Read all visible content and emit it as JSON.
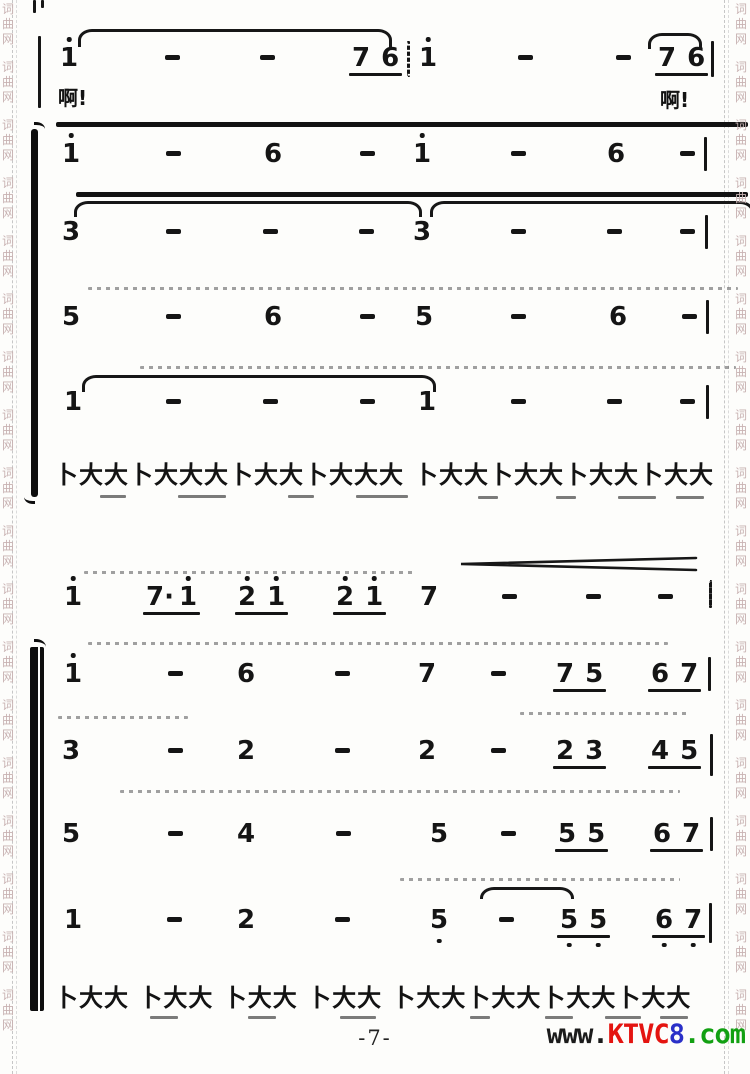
{
  "watermark": {
    "chars": [
      "词",
      "曲",
      "网"
    ],
    "color": "#c8b2b2"
  },
  "lyrics": {
    "ah_left": "啊!",
    "ah_right": "啊!",
    "row1_part1": "卜大大卜大大大卜大大卜大大大",
    "row1_part2": "卜大大卜大大卜大大卜大大",
    "row2": "卜大大 卜大大 卜大大 卜大大 卜大大卜大大卜大大卜大大"
  },
  "footer": {
    "page_number": "-7-",
    "site": [
      {
        "text": "www.",
        "color": "#1b1b1b"
      },
      {
        "text": "KTVC",
        "color": "#e41410"
      },
      {
        "text": "8",
        "color": "#2a30c8"
      },
      {
        "text": ".com",
        "color": "#12a012"
      }
    ]
  },
  "notation": {
    "rows": [
      {
        "id": "tail-voice",
        "y": 44,
        "tokens": [
          {
            "k": "n",
            "x": 60,
            "d": "1",
            "hi": 1
          },
          {
            "k": "d",
            "x": 165
          },
          {
            "k": "d",
            "x": 260
          },
          {
            "k": "p",
            "x": 352,
            "ul": 1,
            "ds": [
              {
                "d": "7"
              },
              {
                "d": "6"
              }
            ]
          },
          {
            "k": "b",
            "x": 407,
            "dot": 1,
            "h": 36
          },
          {
            "k": "n",
            "x": 419,
            "d": "1",
            "hi": 1
          },
          {
            "k": "d",
            "x": 518
          },
          {
            "k": "d",
            "x": 616
          },
          {
            "k": "p",
            "x": 658,
            "ul": 1,
            "ds": [
              {
                "d": "7"
              },
              {
                "d": "6"
              }
            ]
          },
          {
            "k": "b",
            "x": 711,
            "h": 36
          }
        ]
      },
      {
        "id": "s1-v1",
        "y": 140,
        "tokens": [
          {
            "k": "n",
            "x": 62,
            "d": "1",
            "hi": 1
          },
          {
            "k": "d",
            "x": 166
          },
          {
            "k": "n",
            "x": 264,
            "d": "6"
          },
          {
            "k": "d",
            "x": 360
          },
          {
            "k": "n",
            "x": 413,
            "d": "1",
            "hi": 1
          },
          {
            "k": "d",
            "x": 511
          },
          {
            "k": "n",
            "x": 607,
            "d": "6"
          },
          {
            "k": "d",
            "x": 680
          },
          {
            "k": "b",
            "x": 704,
            "h": 34
          }
        ]
      },
      {
        "id": "s1-v2",
        "y": 218,
        "tokens": [
          {
            "k": "n",
            "x": 62,
            "d": "3"
          },
          {
            "k": "d",
            "x": 166
          },
          {
            "k": "d",
            "x": 263
          },
          {
            "k": "d",
            "x": 359
          },
          {
            "k": "n",
            "x": 413,
            "d": "3"
          },
          {
            "k": "d",
            "x": 511
          },
          {
            "k": "d",
            "x": 607
          },
          {
            "k": "d",
            "x": 680
          },
          {
            "k": "b",
            "x": 705,
            "h": 34
          }
        ]
      },
      {
        "id": "s1-v3",
        "y": 303,
        "tokens": [
          {
            "k": "n",
            "x": 62,
            "d": "5"
          },
          {
            "k": "d",
            "x": 166
          },
          {
            "k": "n",
            "x": 264,
            "d": "6"
          },
          {
            "k": "d",
            "x": 360
          },
          {
            "k": "n",
            "x": 415,
            "d": "5"
          },
          {
            "k": "d",
            "x": 511
          },
          {
            "k": "n",
            "x": 609,
            "d": "6"
          },
          {
            "k": "d",
            "x": 682
          },
          {
            "k": "b",
            "x": 706,
            "h": 34
          }
        ]
      },
      {
        "id": "s1-v4",
        "y": 388,
        "tokens": [
          {
            "k": "n",
            "x": 64,
            "d": "1"
          },
          {
            "k": "d",
            "x": 166
          },
          {
            "k": "d",
            "x": 263
          },
          {
            "k": "d",
            "x": 360
          },
          {
            "k": "n",
            "x": 418,
            "d": "1"
          },
          {
            "k": "d",
            "x": 511
          },
          {
            "k": "d",
            "x": 607
          },
          {
            "k": "d",
            "x": 680
          },
          {
            "k": "b",
            "x": 706,
            "h": 34
          }
        ]
      },
      {
        "id": "mid-voice",
        "y": 583,
        "tokens": [
          {
            "k": "n",
            "x": 64,
            "d": "1",
            "hi": 1
          },
          {
            "k": "p",
            "x": 146,
            "ul": 1,
            "g": 5,
            "ds": [
              {
                "d": "7·"
              },
              {
                "d": "1",
                "hi": 1
              }
            ]
          },
          {
            "k": "p",
            "x": 238,
            "ul": 1,
            "ds": [
              {
                "d": "2",
                "hi": 1
              },
              {
                "d": "1",
                "hi": 1
              }
            ]
          },
          {
            "k": "p",
            "x": 336,
            "ul": 1,
            "ds": [
              {
                "d": "2",
                "hi": 1
              },
              {
                "d": "1",
                "hi": 1
              }
            ]
          },
          {
            "k": "n",
            "x": 420,
            "d": "7"
          },
          {
            "k": "d",
            "x": 502
          },
          {
            "k": "d",
            "x": 586
          },
          {
            "k": "d",
            "x": 658
          },
          {
            "k": "b",
            "x": 709,
            "dot": 1,
            "h": 28
          }
        ]
      },
      {
        "id": "s2-v1",
        "y": 660,
        "tokens": [
          {
            "k": "n",
            "x": 64,
            "d": "1",
            "hi": 1
          },
          {
            "k": "d",
            "x": 168
          },
          {
            "k": "n",
            "x": 237,
            "d": "6"
          },
          {
            "k": "d",
            "x": 335
          },
          {
            "k": "n",
            "x": 418,
            "d": "7"
          },
          {
            "k": "d",
            "x": 491
          },
          {
            "k": "p",
            "x": 556,
            "ul": 1,
            "ds": [
              {
                "d": "7"
              },
              {
                "d": "5"
              }
            ]
          },
          {
            "k": "p",
            "x": 651,
            "ul": 1,
            "ds": [
              {
                "d": "6"
              },
              {
                "d": "7"
              }
            ]
          },
          {
            "k": "b",
            "x": 708,
            "h": 34
          }
        ]
      },
      {
        "id": "s2-v2",
        "y": 737,
        "tokens": [
          {
            "k": "n",
            "x": 62,
            "d": "3"
          },
          {
            "k": "d",
            "x": 168
          },
          {
            "k": "n",
            "x": 237,
            "d": "2"
          },
          {
            "k": "d",
            "x": 335
          },
          {
            "k": "n",
            "x": 418,
            "d": "2"
          },
          {
            "k": "d",
            "x": 491
          },
          {
            "k": "p",
            "x": 556,
            "ul": 1,
            "ds": [
              {
                "d": "2"
              },
              {
                "d": "3"
              }
            ]
          },
          {
            "k": "p",
            "x": 651,
            "ul": 1,
            "ds": [
              {
                "d": "4"
              },
              {
                "d": "5"
              }
            ]
          },
          {
            "k": "b",
            "x": 710,
            "h": 42
          }
        ]
      },
      {
        "id": "s2-v3",
        "y": 820,
        "tokens": [
          {
            "k": "n",
            "x": 62,
            "d": "5"
          },
          {
            "k": "d",
            "x": 168
          },
          {
            "k": "n",
            "x": 237,
            "d": "4"
          },
          {
            "k": "d",
            "x": 336
          },
          {
            "k": "n",
            "x": 430,
            "d": "5"
          },
          {
            "k": "d",
            "x": 501
          },
          {
            "k": "p",
            "x": 558,
            "ul": 1,
            "ds": [
              {
                "d": "5"
              },
              {
                "d": "5"
              }
            ]
          },
          {
            "k": "p",
            "x": 653,
            "ul": 1,
            "ds": [
              {
                "d": "6"
              },
              {
                "d": "7"
              }
            ]
          },
          {
            "k": "b",
            "x": 710,
            "h": 34
          }
        ]
      },
      {
        "id": "s2-v4",
        "y": 906,
        "tokens": [
          {
            "k": "n",
            "x": 64,
            "d": "1"
          },
          {
            "k": "d",
            "x": 167
          },
          {
            "k": "n",
            "x": 237,
            "d": "2"
          },
          {
            "k": "d",
            "x": 335
          },
          {
            "k": "n",
            "x": 430,
            "d": "5",
            "lo": 1
          },
          {
            "k": "d",
            "x": 499
          },
          {
            "k": "p",
            "x": 560,
            "ul": 1,
            "ds": [
              {
                "d": "5",
                "lo": 1
              },
              {
                "d": "5",
                "lo": 1
              }
            ]
          },
          {
            "k": "p",
            "x": 655,
            "ul": 1,
            "ds": [
              {
                "d": "6",
                "lo": 1
              },
              {
                "d": "7",
                "lo": 1
              }
            ]
          },
          {
            "k": "b",
            "x": 709,
            "h": 40
          }
        ]
      }
    ],
    "marks": [
      {
        "t": "vl",
        "x": 33,
        "y": 0,
        "h": 13
      },
      {
        "t": "vl",
        "x": 41,
        "y": 0,
        "h": 8
      },
      {
        "t": "slur",
        "x": 78,
        "y": 29,
        "w": 308,
        "h": 15
      },
      {
        "t": "slur",
        "x": 648,
        "y": 33,
        "w": 48,
        "h": 13
      },
      {
        "t": "vl",
        "x": 38,
        "y": 36,
        "h": 72
      },
      {
        "t": "thick",
        "x": 56,
        "y": 122,
        "w": 692
      },
      {
        "t": "brace",
        "x": 31,
        "y": 129,
        "h": 368
      },
      {
        "t": "thick",
        "x": 76,
        "y": 192,
        "w": 672
      },
      {
        "t": "slur",
        "x": 74,
        "y": 201,
        "w": 342,
        "h": 13
      },
      {
        "t": "slur",
        "x": 430,
        "y": 201,
        "w": 318,
        "h": 13
      },
      {
        "t": "noise",
        "x": 88,
        "y": 287,
        "w": 650
      },
      {
        "t": "noise",
        "x": 140,
        "y": 366,
        "w": 596
      },
      {
        "t": "slur",
        "x": 82,
        "y": 375,
        "w": 348,
        "h": 14
      },
      {
        "t": "ld",
        "x": 100,
        "y": 495,
        "w": 26
      },
      {
        "t": "ld",
        "x": 178,
        "y": 495,
        "w": 48
      },
      {
        "t": "ld",
        "x": 288,
        "y": 495,
        "w": 26
      },
      {
        "t": "ld",
        "x": 356,
        "y": 495,
        "w": 52
      },
      {
        "t": "ld",
        "x": 478,
        "y": 496,
        "w": 20
      },
      {
        "t": "ld",
        "x": 556,
        "y": 496,
        "w": 20
      },
      {
        "t": "ld",
        "x": 618,
        "y": 496,
        "w": 38
      },
      {
        "t": "ld",
        "x": 676,
        "y": 496,
        "w": 28
      },
      {
        "t": "noise",
        "x": 84,
        "y": 571,
        "w": 330
      },
      {
        "t": "hairpin",
        "x": 458,
        "y": 555,
        "w": 240,
        "h": 18
      },
      {
        "t": "noise",
        "x": 88,
        "y": 642,
        "w": 580
      },
      {
        "t": "brace2",
        "x": 30,
        "y": 647,
        "h": 364
      },
      {
        "t": "noise",
        "x": 58,
        "y": 716,
        "w": 130
      },
      {
        "t": "noise",
        "x": 520,
        "y": 712,
        "w": 170
      },
      {
        "t": "noise",
        "x": 120,
        "y": 790,
        "w": 560
      },
      {
        "t": "noise",
        "x": 400,
        "y": 878,
        "w": 280
      },
      {
        "t": "slur",
        "x": 480,
        "y": 887,
        "w": 88,
        "h": 9
      },
      {
        "t": "ld",
        "x": 150,
        "y": 1016,
        "w": 28
      },
      {
        "t": "ld",
        "x": 248,
        "y": 1016,
        "w": 28
      },
      {
        "t": "ld",
        "x": 340,
        "y": 1016,
        "w": 36
      },
      {
        "t": "ld",
        "x": 470,
        "y": 1016,
        "w": 20
      },
      {
        "t": "ld",
        "x": 545,
        "y": 1016,
        "w": 28
      },
      {
        "t": "ld",
        "x": 605,
        "y": 1016,
        "w": 36
      },
      {
        "t": "ld",
        "x": 660,
        "y": 1016,
        "w": 28
      }
    ]
  }
}
